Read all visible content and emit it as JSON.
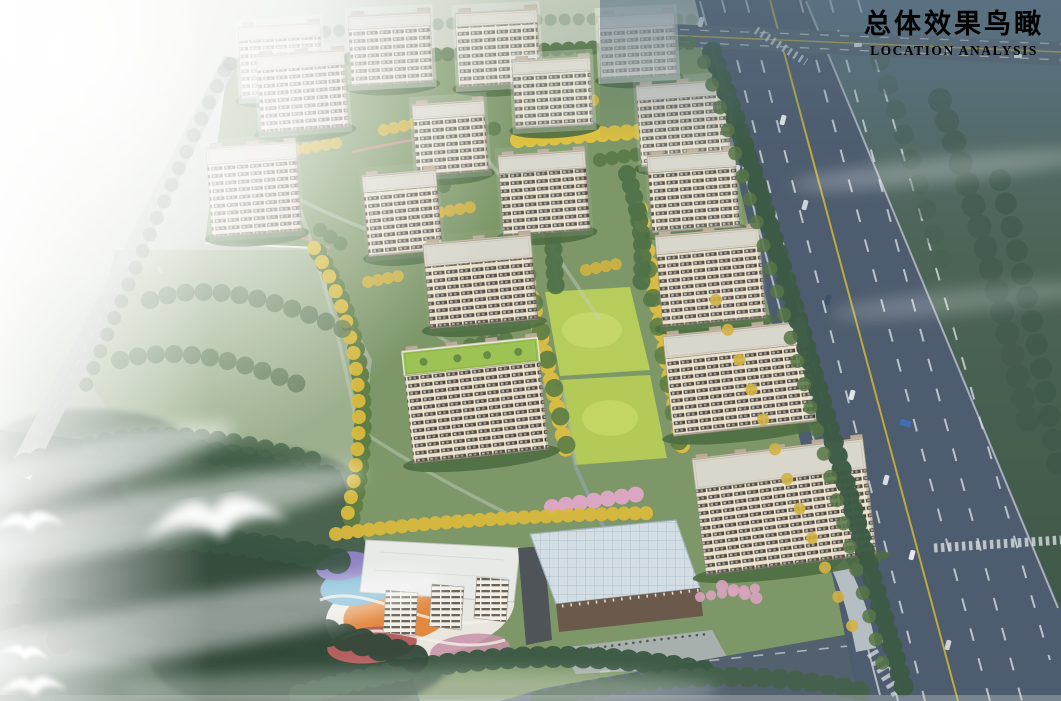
{
  "header": {
    "title": "总体效果鸟瞰",
    "subtitle": "LOCATION ANALYSIS"
  },
  "palette": {
    "haze_white": "#eef0ec",
    "field_green": "#8fa487",
    "forest_green": "#3c5943",
    "site_green": "#7d9768",
    "lawn_bright": "#b7cd5b",
    "tree_yellow": "#d9ba3e",
    "blossom_pink": "#dfa7c6",
    "facade_cream": "#e9e1cd",
    "window_band_brown": "#50463a",
    "roof_gray": "#d8d5cb",
    "asphalt_blue_gray": "#4d5c6e",
    "lane_yellow": "#c9b23c",
    "glass_roof_blue": "#cfdbe2",
    "playground_orange": "#e2883f",
    "playground_purple": "#8f83c4",
    "playground_blue": "#66aecd",
    "title_text": "#1c2935"
  }
}
